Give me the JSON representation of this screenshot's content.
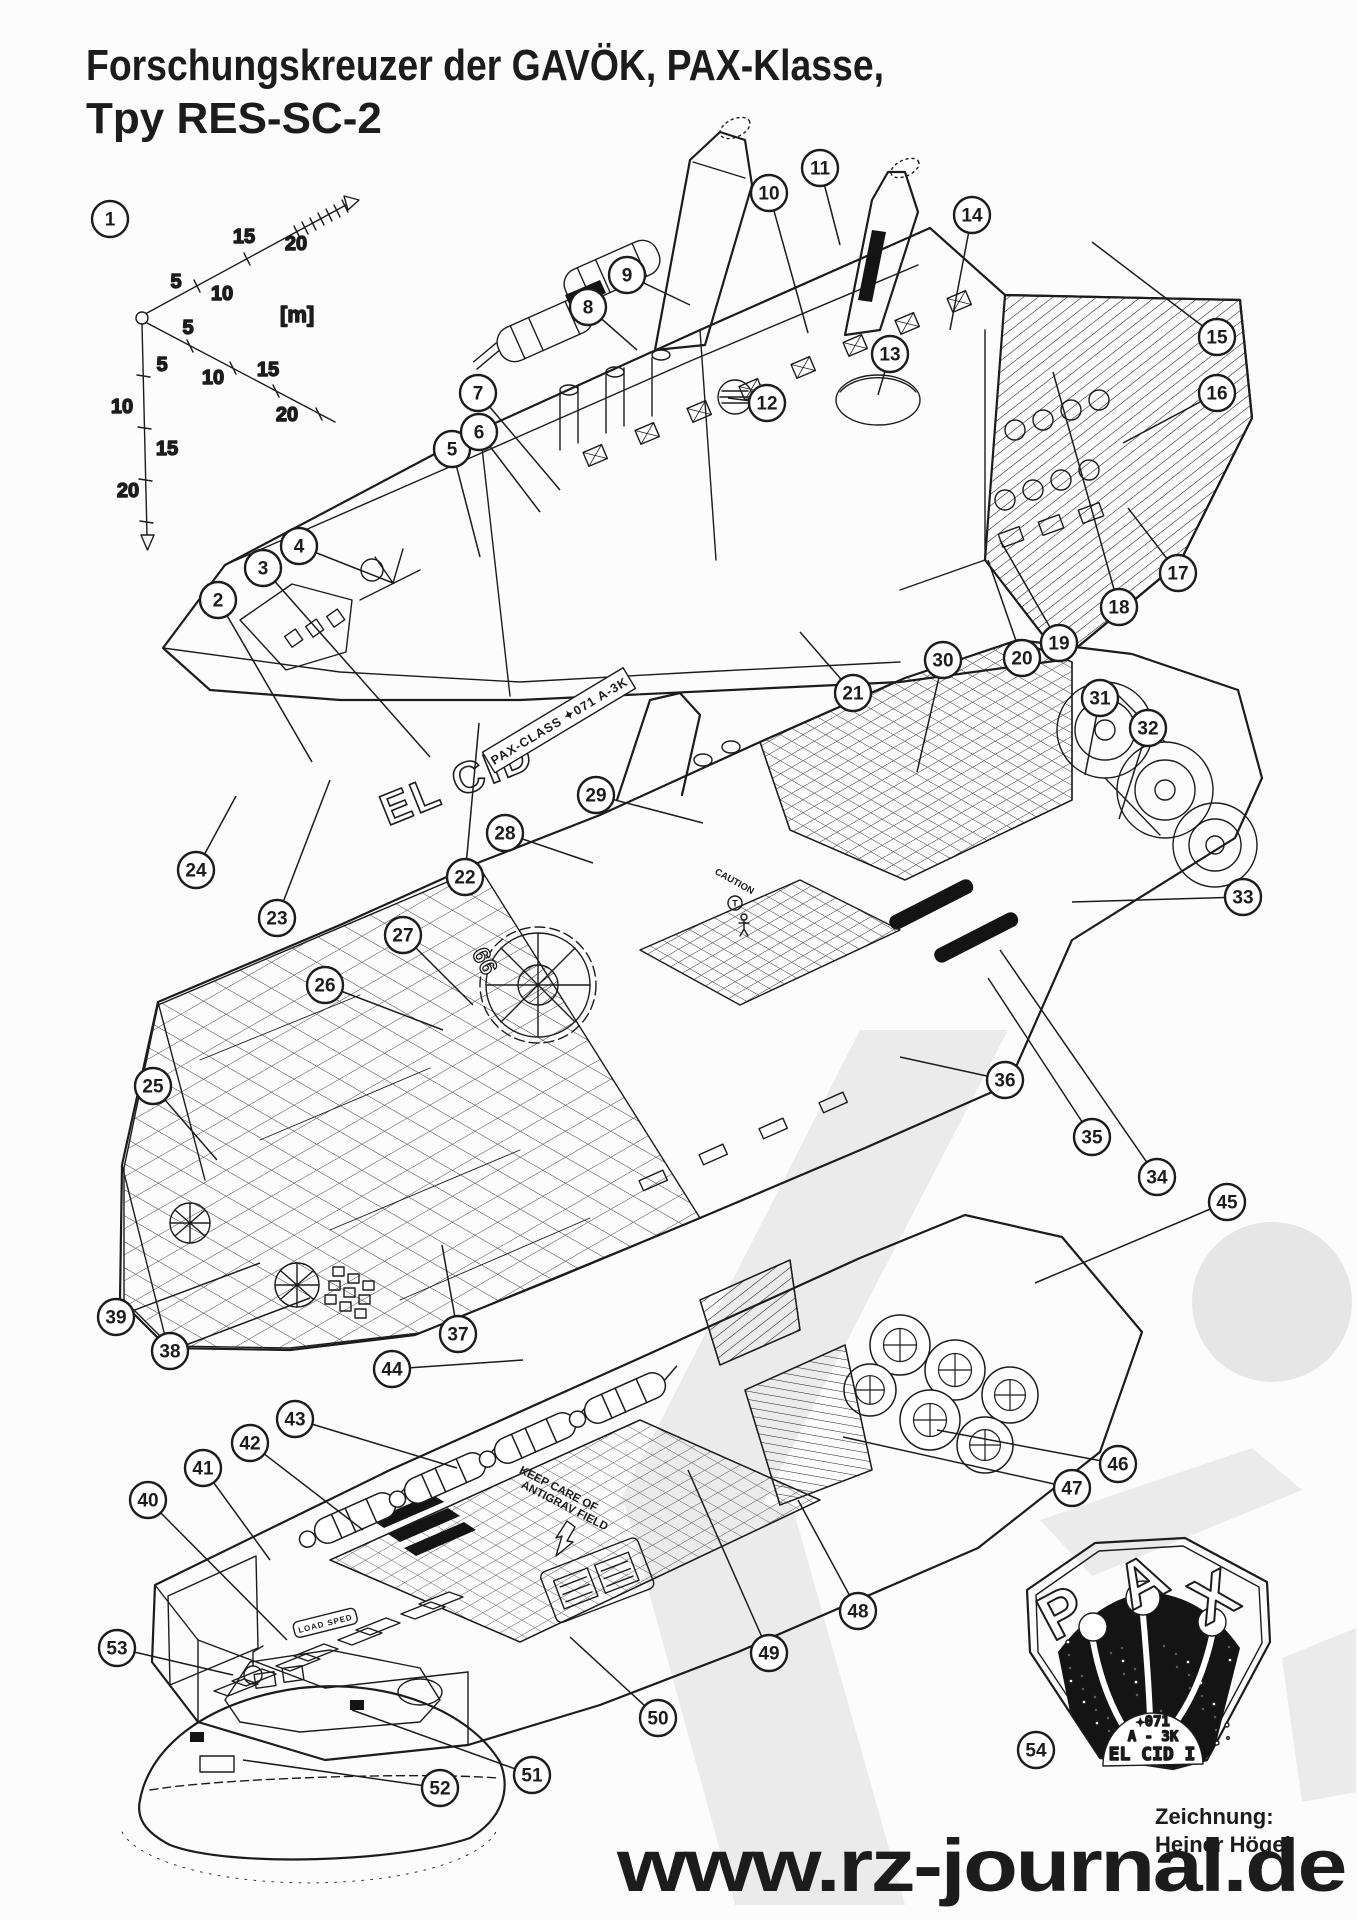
{
  "title": {
    "line1": "Forschungskreuzer der GAVÖK, PAX-Klasse,",
    "line2": "Tpy RES-SC-2"
  },
  "credit": {
    "label": "Zeichnung:",
    "name": "Heiner Högel"
  },
  "watermark": {
    "text": "www.rz-journal.de"
  },
  "scale": {
    "unit_label": "[m]",
    "tick_labels": [
      "5",
      "10",
      "15",
      "20"
    ]
  },
  "ship": {
    "name_marking": "EL CID",
    "class_plate": "PAX-CLASS  ✦071 A-3K",
    "hull_number": "66",
    "deck_signs": [
      {
        "text": "CAUTION"
      },
      {
        "text": "T"
      },
      {
        "text": "KEEP CARE OF"
      },
      {
        "text": "ANTIGRAV FIELD"
      },
      {
        "text": "LOAD SPED"
      }
    ]
  },
  "badge": {
    "letters": [
      "P",
      "A",
      "X"
    ],
    "reg_line1": "✦071",
    "reg_line2": "A - 3K",
    "reg_line3": "EL CID I"
  },
  "colors": {
    "ink": "#1c1c1c",
    "paper": "#fcfcfc",
    "watermark_text": "#d8d8d8",
    "watermark_shape": "#ebebeb"
  },
  "callouts": [
    {
      "n": "1",
      "x": 110,
      "y": 219,
      "lx": null,
      "ly": null
    },
    {
      "n": "2",
      "x": 218,
      "y": 600,
      "lx": 312,
      "ly": 762
    },
    {
      "n": "3",
      "x": 263,
      "y": 568,
      "lx": 430,
      "ly": 757
    },
    {
      "n": "4",
      "x": 299,
      "y": 546,
      "lx": 393,
      "ly": 583
    },
    {
      "n": "5",
      "x": 452,
      "y": 449,
      "lx": 480,
      "ly": 557
    },
    {
      "n": "6",
      "x": 479,
      "y": 432,
      "lx": 540,
      "ly": 512
    },
    {
      "n": "7",
      "x": 478,
      "y": 393,
      "lx": 560,
      "ly": 490
    },
    {
      "n": "8",
      "x": 588,
      "y": 307,
      "lx": 637,
      "ly": 350
    },
    {
      "n": "9",
      "x": 627,
      "y": 275,
      "lx": 690,
      "ly": 305
    },
    {
      "n": "10",
      "x": 769,
      "y": 193,
      "lx": 808,
      "ly": 333
    },
    {
      "n": "11",
      "x": 820,
      "y": 168,
      "lx": 840,
      "ly": 245
    },
    {
      "n": "12",
      "x": 767,
      "y": 403,
      "lx": 728,
      "ly": 398
    },
    {
      "n": "13",
      "x": 890,
      "y": 354,
      "lx": 878,
      "ly": 395
    },
    {
      "n": "14",
      "x": 972,
      "y": 215,
      "lx": 950,
      "ly": 330
    },
    {
      "n": "15",
      "x": 1217,
      "y": 337,
      "lx": 1092,
      "ly": 242
    },
    {
      "n": "16",
      "x": 1217,
      "y": 393,
      "lx": 1123,
      "ly": 443
    },
    {
      "n": "17",
      "x": 1178,
      "y": 573,
      "lx": 1128,
      "ly": 508
    },
    {
      "n": "18",
      "x": 1119,
      "y": 607,
      "lx": 1053,
      "ly": 372
    },
    {
      "n": "19",
      "x": 1059,
      "y": 643,
      "lx": 1000,
      "ly": 540
    },
    {
      "n": "20",
      "x": 1022,
      "y": 658,
      "lx": 988,
      "ly": 560
    },
    {
      "n": "21",
      "x": 853,
      "y": 693,
      "lx": 800,
      "ly": 632
    },
    {
      "n": "22",
      "x": 465,
      "y": 877,
      "lx": 479,
      "ly": 723
    },
    {
      "n": "23",
      "x": 277,
      "y": 918,
      "lx": 330,
      "ly": 780
    },
    {
      "n": "24",
      "x": 196,
      "y": 870,
      "lx": 236,
      "ly": 796
    },
    {
      "n": "25",
      "x": 153,
      "y": 1086,
      "lx": 217,
      "ly": 1160
    },
    {
      "n": "26",
      "x": 325,
      "y": 985,
      "lx": 443,
      "ly": 1030
    },
    {
      "n": "27",
      "x": 403,
      "y": 935,
      "lx": 473,
      "ly": 1005
    },
    {
      "n": "28",
      "x": 505,
      "y": 833,
      "lx": 593,
      "ly": 863
    },
    {
      "n": "29",
      "x": 596,
      "y": 795,
      "lx": 703,
      "ly": 823
    },
    {
      "n": "30",
      "x": 943,
      "y": 660,
      "lx": 917,
      "ly": 772
    },
    {
      "n": "31",
      "x": 1100,
      "y": 698,
      "lx": 1085,
      "ly": 775
    },
    {
      "n": "32",
      "x": 1148,
      "y": 728,
      "lx": 1119,
      "ly": 819
    },
    {
      "n": "33",
      "x": 1243,
      "y": 897,
      "lx": 1072,
      "ly": 902
    },
    {
      "n": "34",
      "x": 1157,
      "y": 1177,
      "lx": 1000,
      "ly": 950
    },
    {
      "n": "35",
      "x": 1092,
      "y": 1137,
      "lx": 988,
      "ly": 978
    },
    {
      "n": "36",
      "x": 1005,
      "y": 1080,
      "lx": 900,
      "ly": 1057
    },
    {
      "n": "37",
      "x": 458,
      "y": 1334,
      "lx": 442,
      "ly": 1245
    },
    {
      "n": "38",
      "x": 170,
      "y": 1351,
      "lx": 310,
      "ly": 1298
    },
    {
      "n": "39",
      "x": 116,
      "y": 1317,
      "lx": 260,
      "ly": 1263
    },
    {
      "n": "40",
      "x": 148,
      "y": 1500,
      "lx": 287,
      "ly": 1640
    },
    {
      "n": "41",
      "x": 203,
      "y": 1468,
      "lx": 270,
      "ly": 1560
    },
    {
      "n": "42",
      "x": 250,
      "y": 1443,
      "lx": 363,
      "ly": 1530
    },
    {
      "n": "43",
      "x": 295,
      "y": 1419,
      "lx": 457,
      "ly": 1468
    },
    {
      "n": "44",
      "x": 392,
      "y": 1369,
      "lx": 523,
      "ly": 1360
    },
    {
      "n": "45",
      "x": 1227,
      "y": 1202,
      "lx": 1035,
      "ly": 1283
    },
    {
      "n": "46",
      "x": 1118,
      "y": 1464,
      "lx": 937,
      "ly": 1430
    },
    {
      "n": "47",
      "x": 1072,
      "y": 1488,
      "lx": 843,
      "ly": 1437
    },
    {
      "n": "48",
      "x": 858,
      "y": 1611,
      "lx": 798,
      "ly": 1500
    },
    {
      "n": "49",
      "x": 769,
      "y": 1653,
      "lx": 688,
      "ly": 1470
    },
    {
      "n": "50",
      "x": 658,
      "y": 1718,
      "lx": 570,
      "ly": 1637
    },
    {
      "n": "51",
      "x": 532,
      "y": 1775,
      "lx": 352,
      "ly": 1710
    },
    {
      "n": "52",
      "x": 440,
      "y": 1788,
      "lx": 243,
      "ly": 1760
    },
    {
      "n": "53",
      "x": 117,
      "y": 1648,
      "lx": 233,
      "ly": 1675
    },
    {
      "n": "54",
      "x": 1036,
      "y": 1750,
      "lx": null,
      "ly": null
    }
  ]
}
